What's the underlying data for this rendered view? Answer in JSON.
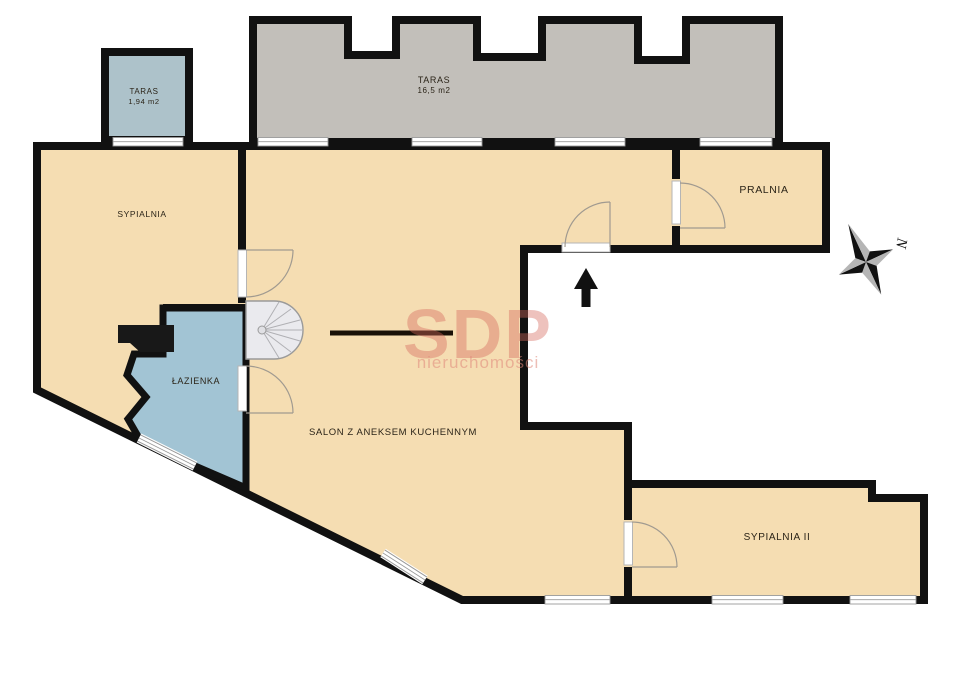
{
  "plan": {
    "title": "apartment-floor-plan",
    "rooms": {
      "taras_small": {
        "label": "TARAS",
        "area": "1,94 m2"
      },
      "taras_big": {
        "label": "TARAS",
        "area": "16,5 m2"
      },
      "sypialnia": {
        "label": "SYPIALNIA"
      },
      "pralnia": {
        "label": "PRALNIA"
      },
      "lazienka": {
        "label": "ŁAZIENKA"
      },
      "salon": {
        "label": "SALON Z ANEKSEM KUCHENNYM"
      },
      "sypialnia2": {
        "label": "SYPIALNIA II"
      }
    },
    "watermark": {
      "brand": "SDP",
      "tagline": "nieruchomości"
    },
    "compass": {
      "north_label": "N"
    },
    "colors": {
      "wall": "#111111",
      "room_fill": "#f5ddb2",
      "terrace_big_fill": "#c2bfba",
      "terrace_small_fill": "#adc2ca",
      "bathroom_fill": "#a2c4d4",
      "stairs_fill": "#eaeaee",
      "frame_gray": "#9a9a9a",
      "watermark_red": "#d5685c"
    }
  }
}
